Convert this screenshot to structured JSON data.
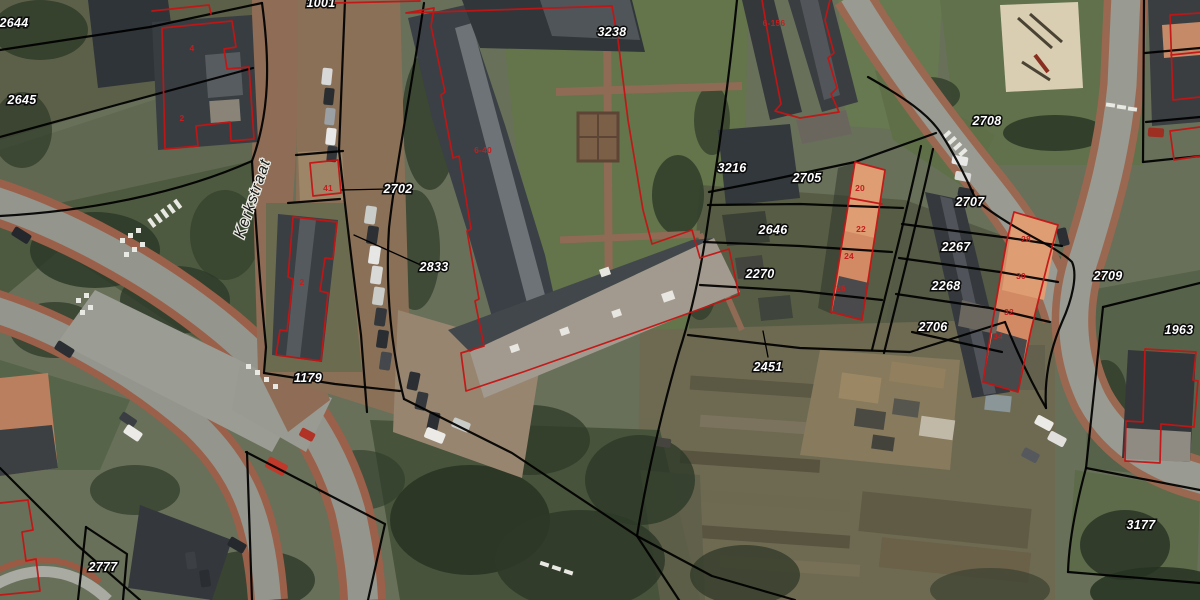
{
  "map": {
    "type": "aerial-cadastral-map",
    "street_label": {
      "text": "Kerkstraat",
      "x": 257,
      "y": 200,
      "rotation": -71
    },
    "parcel_labels": [
      {
        "text": "2644",
        "x": 14,
        "y": 27
      },
      {
        "text": "2645",
        "x": 22,
        "y": 104
      },
      {
        "text": "1001",
        "x": 321,
        "y": 7
      },
      {
        "text": "3238",
        "x": 612,
        "y": 36
      },
      {
        "text": "2702",
        "x": 398,
        "y": 193
      },
      {
        "text": "2833",
        "x": 434,
        "y": 271
      },
      {
        "text": "1179",
        "x": 308,
        "y": 382
      },
      {
        "text": "3216",
        "x": 732,
        "y": 172
      },
      {
        "text": "2705",
        "x": 807,
        "y": 182
      },
      {
        "text": "2646",
        "x": 773,
        "y": 234
      },
      {
        "text": "2270",
        "x": 760,
        "y": 278
      },
      {
        "text": "2451",
        "x": 768,
        "y": 371
      },
      {
        "text": "2708",
        "x": 987,
        "y": 125
      },
      {
        "text": "2707",
        "x": 970,
        "y": 206
      },
      {
        "text": "2267",
        "x": 956,
        "y": 251
      },
      {
        "text": "2268",
        "x": 946,
        "y": 290
      },
      {
        "text": "2706",
        "x": 933,
        "y": 331
      },
      {
        "text": "2709",
        "x": 1108,
        "y": 280
      },
      {
        "text": "1963",
        "x": 1179,
        "y": 334
      },
      {
        "text": "3177",
        "x": 1141,
        "y": 529
      },
      {
        "text": "2777",
        "x": 103,
        "y": 571
      }
    ],
    "house_numbers": [
      {
        "text": "4",
        "x": 192,
        "y": 51
      },
      {
        "text": "2",
        "x": 182,
        "y": 121
      },
      {
        "text": "41",
        "x": 328,
        "y": 191
      },
      {
        "text": "6-40",
        "x": 483,
        "y": 153
      },
      {
        "text": "6-156",
        "x": 774,
        "y": 26
      },
      {
        "text": "2",
        "x": 302,
        "y": 285
      },
      {
        "text": "20",
        "x": 860,
        "y": 191
      },
      {
        "text": "22",
        "x": 861,
        "y": 232
      },
      {
        "text": "24",
        "x": 849,
        "y": 259
      },
      {
        "text": "26",
        "x": 841,
        "y": 291
      },
      {
        "text": "28",
        "x": 1026,
        "y": 242
      },
      {
        "text": "30",
        "x": 1021,
        "y": 279
      },
      {
        "text": "32",
        "x": 1009,
        "y": 315
      },
      {
        "text": "34",
        "x": 998,
        "y": 339
      }
    ],
    "colors": {
      "parcel_boundary": "#000000",
      "building_outline": "#c41414",
      "parcel_label_fill": "#ffffff",
      "parcel_label_halo": "#0a0a0a",
      "house_number": "#c41e1e"
    }
  }
}
